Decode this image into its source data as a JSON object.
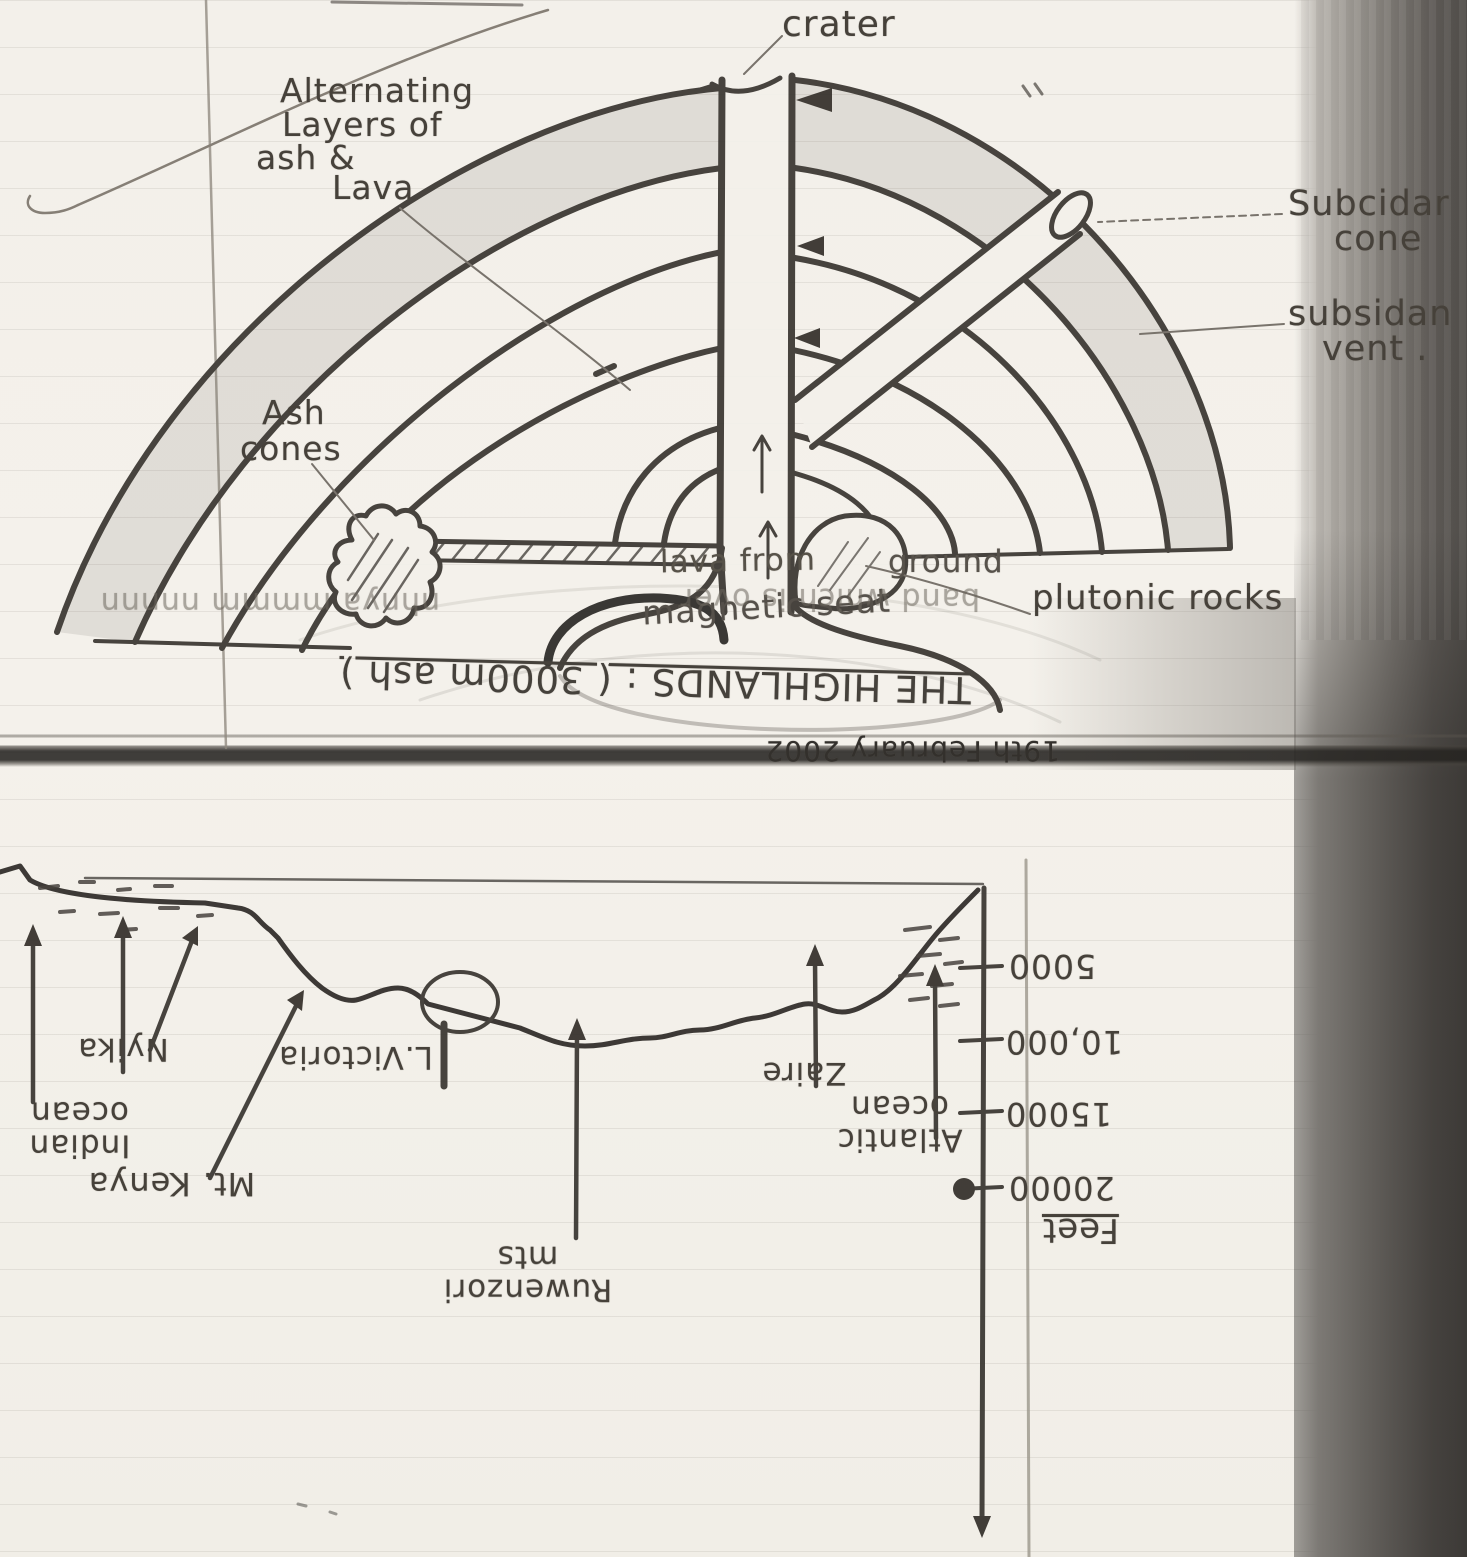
{
  "volcano": {
    "crater": "crater",
    "alternating_l1": "Alternating",
    "alternating_l2": "Layers of",
    "alternating_l3": "ash &",
    "alternating_l4": "Lava",
    "subsidiary_cone_l1": "Subcidar",
    "subsidiary_cone_l2": "cone",
    "subsidiary_vent_l1": "subsidan",
    "subsidiary_vent_l2": "vent .",
    "ash_cones_l1": "Ash",
    "ash_cones_l2": "cones",
    "lava_from": "lava from",
    "magmatic_seat": "magnetic seat",
    "ground": "ground",
    "plutonic_rocks": "plutonic rocks"
  },
  "show_through": {
    "faint_left": "nhnya mmmm nnnnn",
    "faint_right": "band which is over",
    "highlands": "THE HIGHLANDS : ( 3000m ash )",
    "date": "19th February 2002"
  },
  "profile": {
    "indian_l1": "Indian",
    "indian_l2": "ocean",
    "nyika": "Nyika",
    "mt_kenya": "Mt. Kenya",
    "l_victoria": "L.Victoria",
    "ruwenzori_l1": "Ruwenzori",
    "ruwenzori_l2": "mts",
    "zaire": "Zaire",
    "atlantic_l1": "Atlantic",
    "atlantic_l2": "ocean",
    "scale": {
      "v1": "5000",
      "v2": "10,000",
      "v3": "15000",
      "v4": "20000",
      "unit": "Feet"
    }
  }
}
